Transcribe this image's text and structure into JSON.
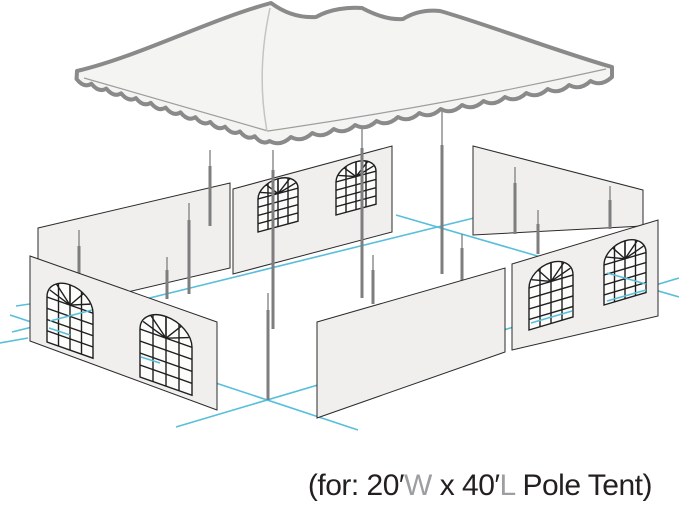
{
  "caption": {
    "prefix": "(for: 20′",
    "width_letter": "W",
    "mid": " x 40′",
    "length_letter": "L",
    "suffix": " Pole Tent)"
  },
  "colors": {
    "canopy_outline": "#8a8a8a",
    "canopy_fill": "#f4f4f2",
    "wall_fill": "#f0efed",
    "wall_stroke": "#2b2b2b",
    "window_stroke": "#1f1f1f",
    "accent": "#58bfda",
    "pole": "#7e7e7e",
    "caption_dark": "#231f20",
    "caption_gray": "#9c9ea1",
    "bg": "#ffffff"
  },
  "scene": {
    "type": "exploded-assembly-diagram",
    "subject": "pole tent with sidewalls",
    "canopy_peaks": 3,
    "center_poles": 3,
    "side_poles": 10,
    "wall_panels": 6,
    "windowed_panels": 3,
    "windows_per_panel": 2,
    "footprint_outline_color": "#58bfda"
  }
}
